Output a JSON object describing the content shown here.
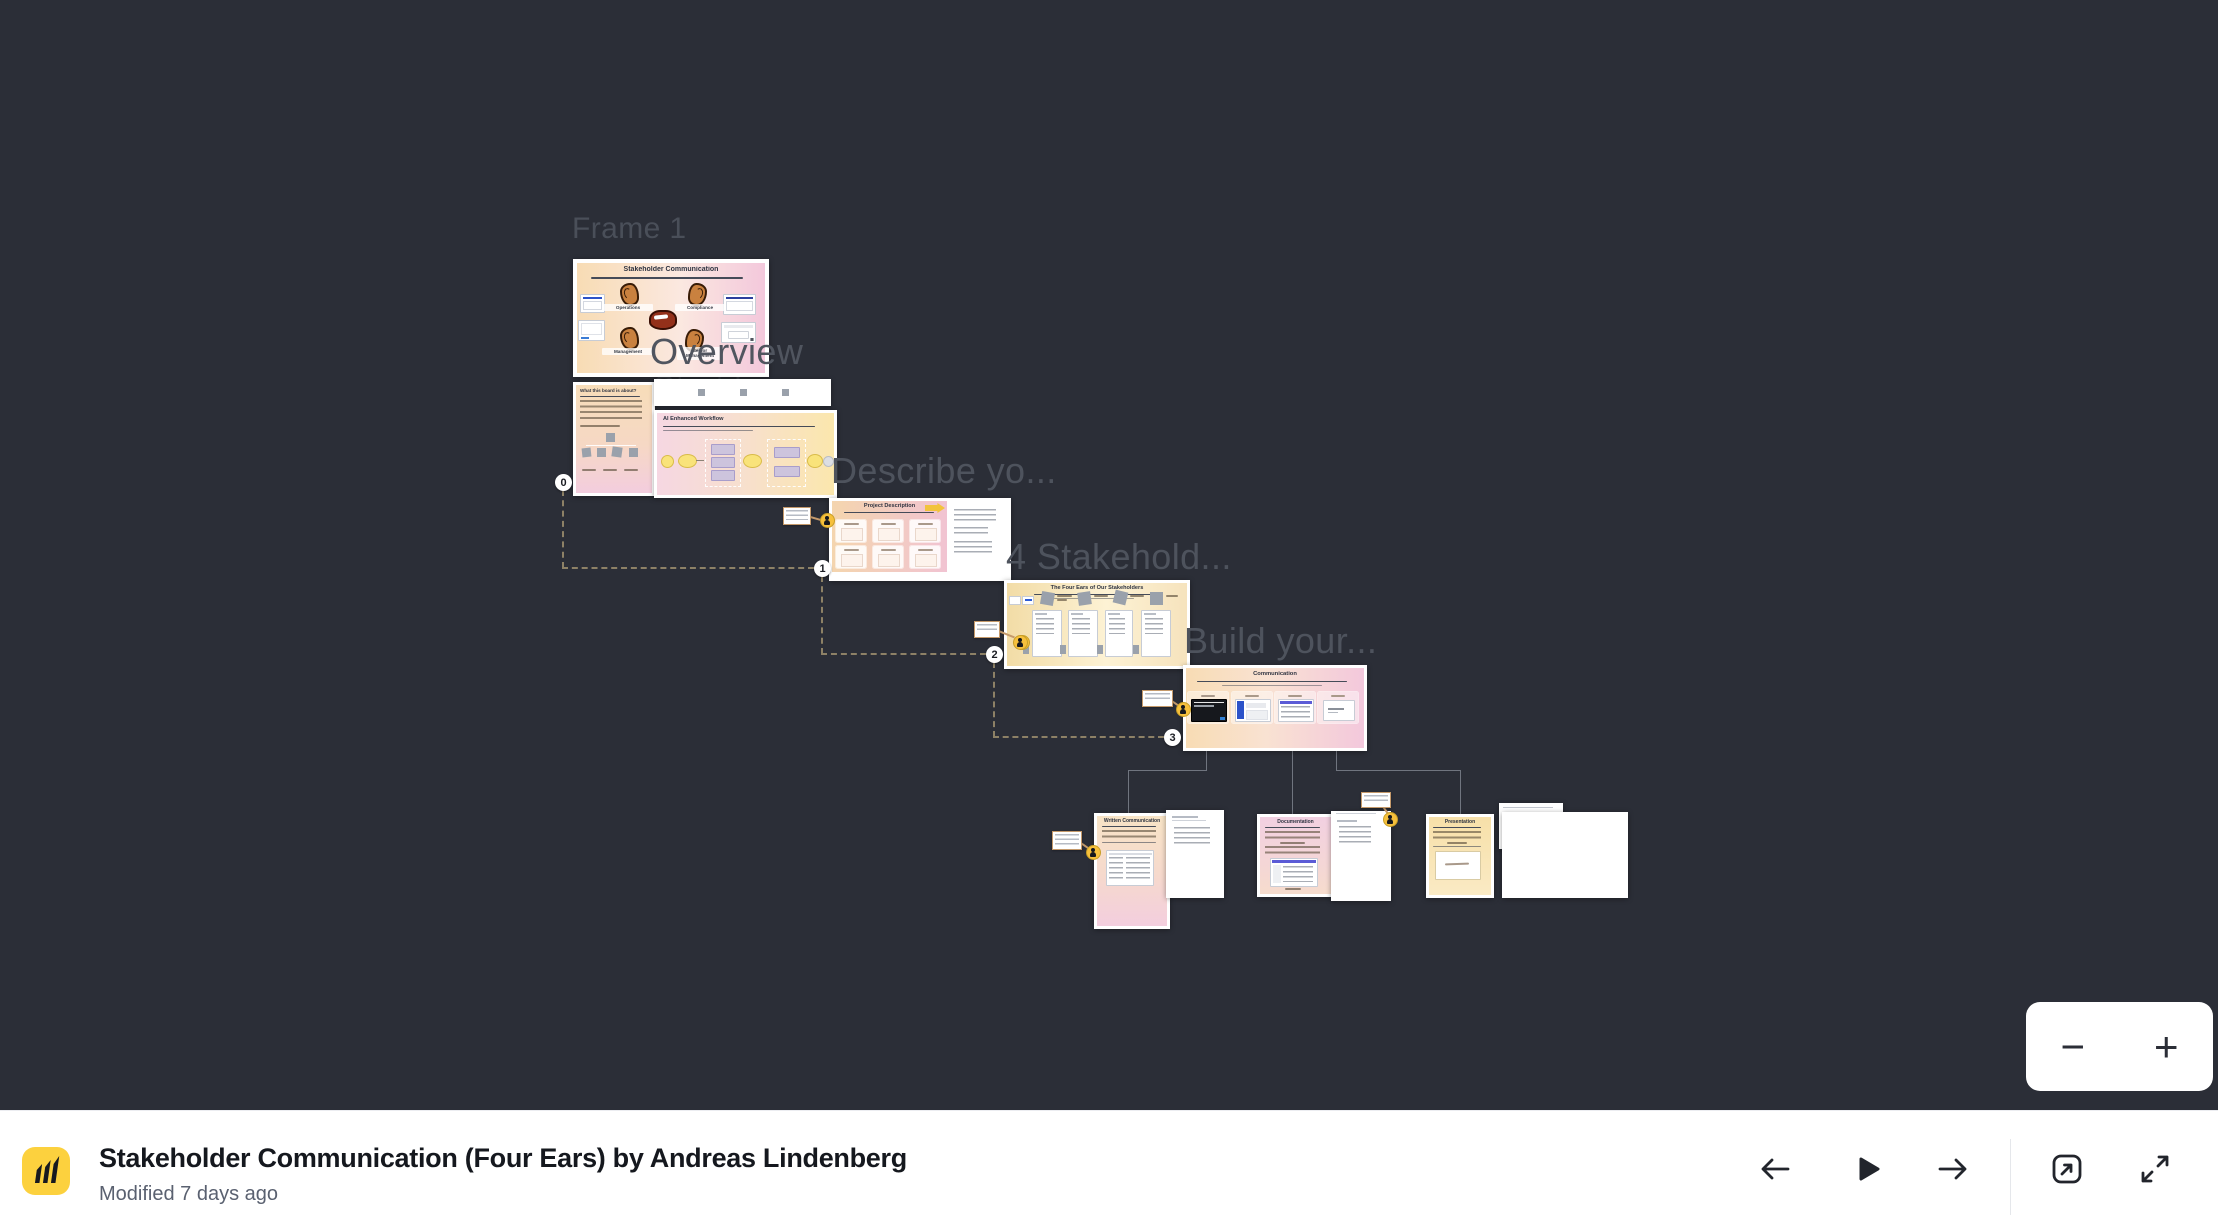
{
  "canvas": {
    "bg": "#2b2e37",
    "labels": {
      "frame1": "Frame 1",
      "overview": "Overview",
      "start_here": "Start here",
      "describe": "Describe yo...",
      "stakeholders": "4 Stakehold...",
      "build": "Build your..."
    },
    "step_markers": [
      "0",
      "1",
      "2",
      "3"
    ],
    "boards": {
      "stakeholder_communication": {
        "title": "Stakeholder Communication",
        "ears": [
          "Operations",
          "Compliance",
          "Management",
          "Senior Management"
        ]
      },
      "about": {
        "title": "What this board is about?"
      },
      "workflow": {
        "title": "AI Enhanced Workflow"
      },
      "project_description": {
        "title": "Project Description"
      },
      "four_ears": {
        "title": "The Four Ears of Our Stakeholders"
      },
      "communication": {
        "title": "Communication"
      },
      "written_communication": {
        "title": "Written Communication"
      },
      "documentation": {
        "title": "Documentation"
      },
      "presentation": {
        "title": "Presentation"
      }
    }
  },
  "zoom_controls": {
    "zoom_out": "−",
    "zoom_in": "+"
  },
  "footer": {
    "title": "Stakeholder Communication (Four Ears) by Andreas Lindenberg",
    "modified": "Modified 7 days ago"
  },
  "colors": {
    "brand_yellow": "#fcd13e",
    "canvas_bg": "#2b2e37",
    "connector_dash": "#8d8166"
  }
}
